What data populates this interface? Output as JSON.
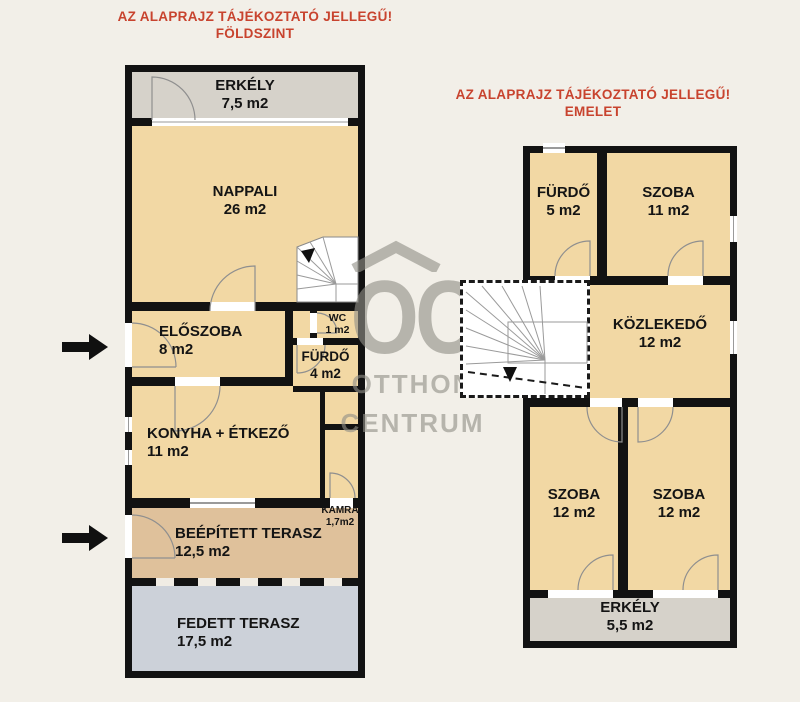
{
  "titles": {
    "left": {
      "line1": "AZ ALAPRAJZ TÁJÉKOZTATÓ JELLEGŰ!",
      "line2": "FÖLDSZINT"
    },
    "right": {
      "line1": "AZ ALAPRAJZ TÁJÉKOZTATÓ JELLEGŰ!",
      "line2": "EMELET"
    }
  },
  "colors": {
    "background": "#f2efe8",
    "wall": "#121212",
    "room_fill": "#f2d8a4",
    "balcony_fill": "#d6d2ca",
    "built_terrace_fill": "#dfc19b",
    "covered_terrace_fill": "#ccd1d9",
    "title_red": "#c8432e",
    "watermark_gray": "#928f88"
  },
  "ground_floor": {
    "erkely": {
      "name": "ERKÉLY",
      "area": "7,5 m2"
    },
    "nappali": {
      "name": "NAPPALI",
      "area": "26 m2"
    },
    "eloszoba": {
      "name": "ELŐSZOBA",
      "area": "8 m2"
    },
    "wc": {
      "name": "WC",
      "area": "1 m2"
    },
    "furdo": {
      "name": "FÜRDŐ",
      "area": "4 m2"
    },
    "konyha": {
      "name": "KONYHA + ÉTKEZŐ",
      "area": "11 m2"
    },
    "kamra": {
      "name": "KAMRA",
      "area": "1,7m2"
    },
    "beepitett": {
      "name": "BEÉPÍTETT TERASZ",
      "area": "12,5 m2"
    },
    "fedett": {
      "name": "FEDETT TERASZ",
      "area": "17,5 m2"
    }
  },
  "upper_floor": {
    "furdo": {
      "name": "FÜRDŐ",
      "area": "5 m2"
    },
    "szoba1": {
      "name": "SZOBA",
      "area": "11 m2"
    },
    "kozlekedo": {
      "name": "KÖZLEKEDŐ",
      "area": "12 m2"
    },
    "szoba2": {
      "name": "SZOBA",
      "area": "12 m2"
    },
    "szoba3": {
      "name": "SZOBA",
      "area": "12 m2"
    },
    "erkely": {
      "name": "ERKÉLY",
      "area": "5,5 m2"
    }
  },
  "watermark": {
    "logo": "OC",
    "line1": "OTTHON",
    "line2": "CENTRUM"
  }
}
